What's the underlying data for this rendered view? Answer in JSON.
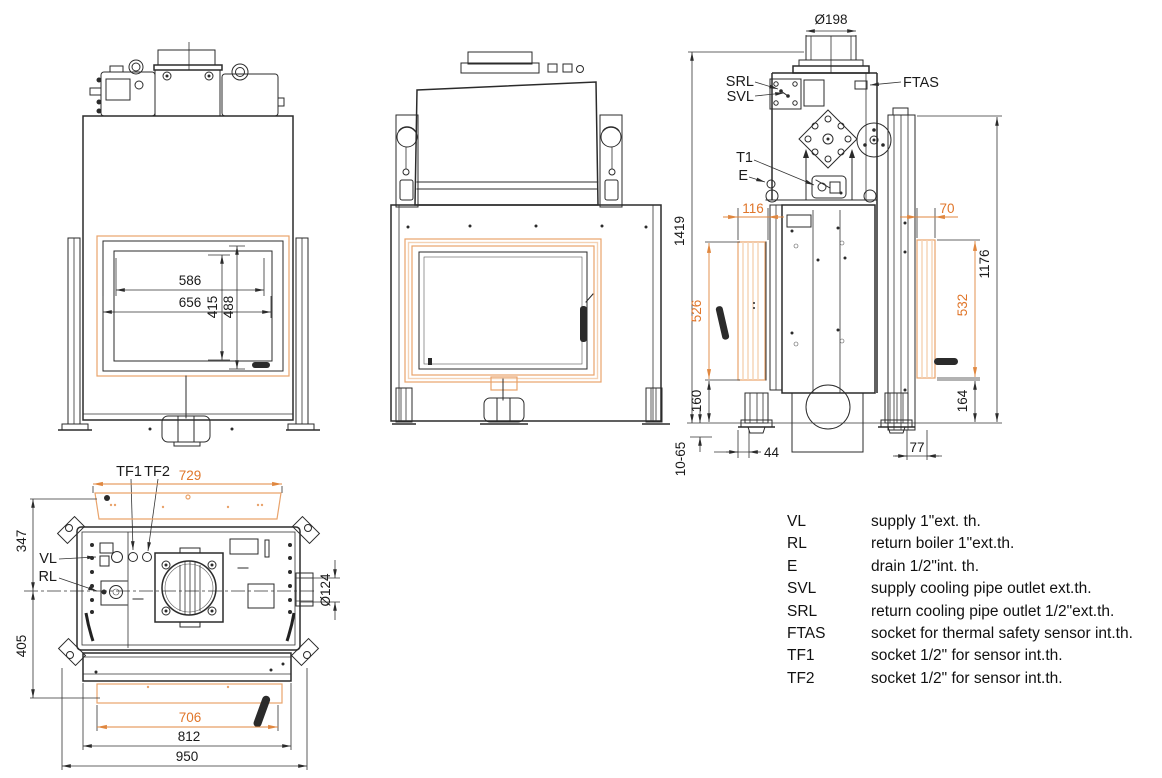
{
  "colors": {
    "accent": "#e0762a",
    "accent_light": "#e9a36b",
    "line": "#2b2b2b"
  },
  "views": {
    "front": {
      "dims": {
        "glass_width": "586",
        "door_width": "656",
        "glass_height": "415",
        "door_height": "488"
      }
    },
    "side": {
      "dims": {
        "flue_diameter": "Ø198",
        "overall_height": "1419",
        "front_frame_depth": "116",
        "front_frame_height": "526",
        "front_base_height": "160",
        "foot_adjust_range": "10-65",
        "front_foot_offset": "44",
        "rear_panel_depth": "70",
        "rear_panel_height": "532",
        "rear_height": "1176",
        "rear_base_height": "164",
        "rear_foot_offset": "77"
      },
      "labels": {
        "srl": "SRL",
        "svl": "SVL",
        "ftas": "FTAS",
        "t1": "T1",
        "e": "E"
      }
    },
    "top": {
      "dims": {
        "top_flange_width": "729",
        "rear_depth": "347",
        "front_depth": "405",
        "flue_outlet_diameter": "Ø124",
        "front_frame_width": "706",
        "body_width": "812",
        "overall_width": "950"
      },
      "labels": {
        "tf1": "TF1",
        "tf2": "TF2",
        "vl": "VL",
        "rl": "RL"
      }
    }
  },
  "legend": {
    "rows": [
      {
        "key": "VL",
        "desc": "supply 1\"ext. th."
      },
      {
        "key": "RL",
        "desc": "return boiler 1\"ext.th."
      },
      {
        "key": "E",
        "desc": "drain 1/2\"int. th."
      },
      {
        "key": "SVL",
        "desc": "supply cooling pipe outlet ext.th."
      },
      {
        "key": "SRL",
        "desc": "return cooling pipe outlet 1/2\"ext.th."
      },
      {
        "key": "FTAS",
        "desc": "socket for thermal safety sensor int.th."
      },
      {
        "key": "TF1",
        "desc": "socket 1/2\" for sensor int.th."
      },
      {
        "key": "TF2",
        "desc": "socket 1/2\" for sensor int.th."
      }
    ]
  }
}
